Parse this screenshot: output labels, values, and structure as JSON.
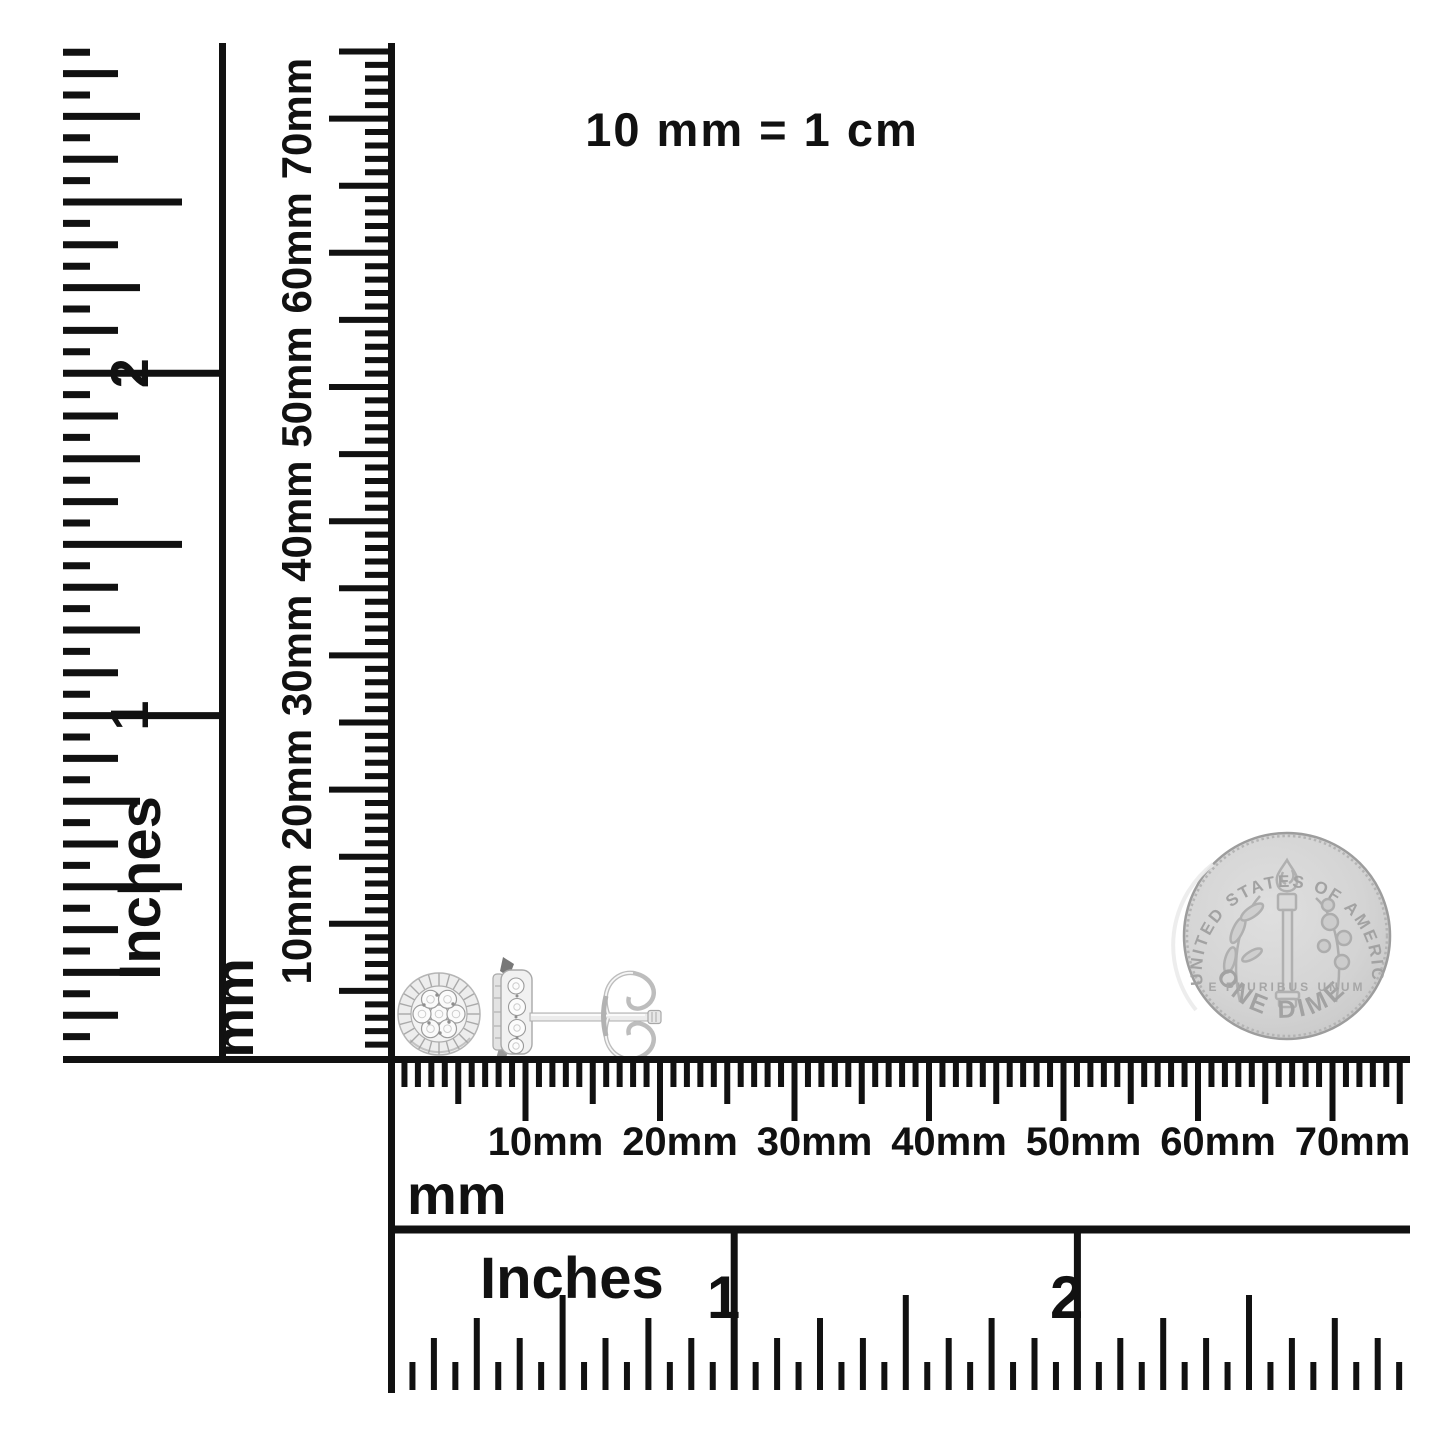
{
  "note": {
    "text": "10 mm = 1 cm"
  },
  "rulers": {
    "left_inches": {
      "unit_label": "Inches",
      "numbers": [
        "1",
        "2"
      ],
      "divisions_per_inch": 16,
      "span_inches": 3
    },
    "vertical_mm": {
      "unit_label": "mm",
      "labels": [
        "10mm",
        "20mm",
        "30mm",
        "40mm",
        "50mm",
        "60mm",
        "70mm"
      ],
      "span_mm": 75
    },
    "horizontal_mm": {
      "unit_label": "mm",
      "labels": [
        "10mm",
        "20mm",
        "30mm",
        "40mm",
        "50mm",
        "60mm",
        "70mm"
      ],
      "span_mm": 75
    },
    "bottom_inches": {
      "unit_label": "Inches",
      "numbers": [
        "1",
        "2"
      ],
      "divisions_per_inch": 16,
      "span_inches": 3
    }
  },
  "objects": {
    "earrings": {
      "description": "Pair of round diamond cluster stud earrings, front view and side view with friction post and butterfly back"
    },
    "coin": {
      "description": "United States dime (reverse) shown for scale",
      "top_text": "UNITED STATES OF AMERICA",
      "bottom_text": "ONE DIME",
      "middle_text": "E PLURIBUS UNUM"
    }
  },
  "colors": {
    "background": "#ffffff",
    "ink": "#111111",
    "coin_fill": "#d2d2d2",
    "coin_detail": "#aaaaaa",
    "metal": "#efefef",
    "metal_detail": "#a5a5a5"
  }
}
